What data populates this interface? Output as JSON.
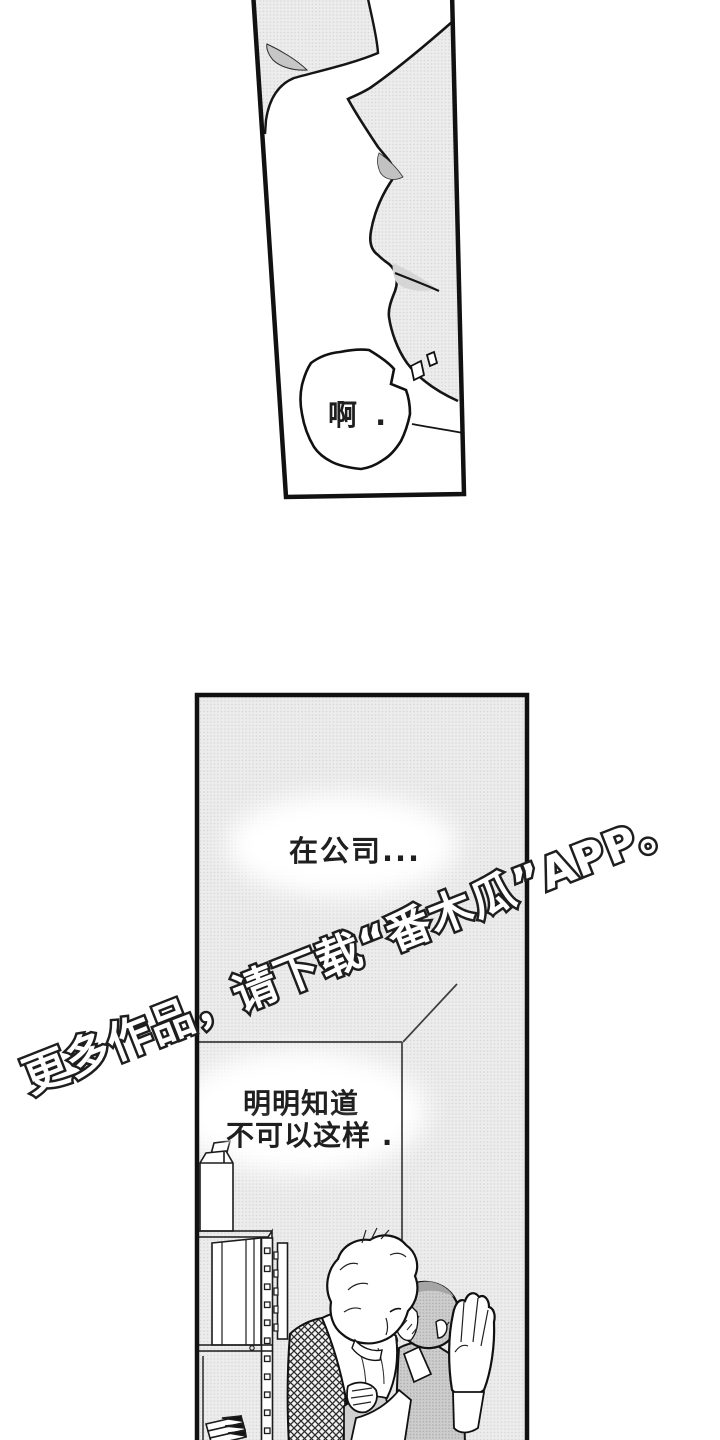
{
  "page": {
    "kind": "manga-page",
    "colors": {
      "background": "#ffffff",
      "ink": "#151515",
      "tone_light": "#ececec",
      "tone_dot": "#d7d7d7",
      "tone_hair": "#cdcdcd",
      "tone_hair_dot": "#aeaeae",
      "shadow_gray": "#c6c6c6"
    }
  },
  "top_panel": {
    "bubble_text": "啊 ."
  },
  "bottom_panel": {
    "narration_1": "在公司...",
    "narration_2_line1": "明明知道",
    "narration_2_line2": "不可以这样 ."
  },
  "watermark": {
    "text": "更多作品，请下载“番木瓜”APP。"
  }
}
